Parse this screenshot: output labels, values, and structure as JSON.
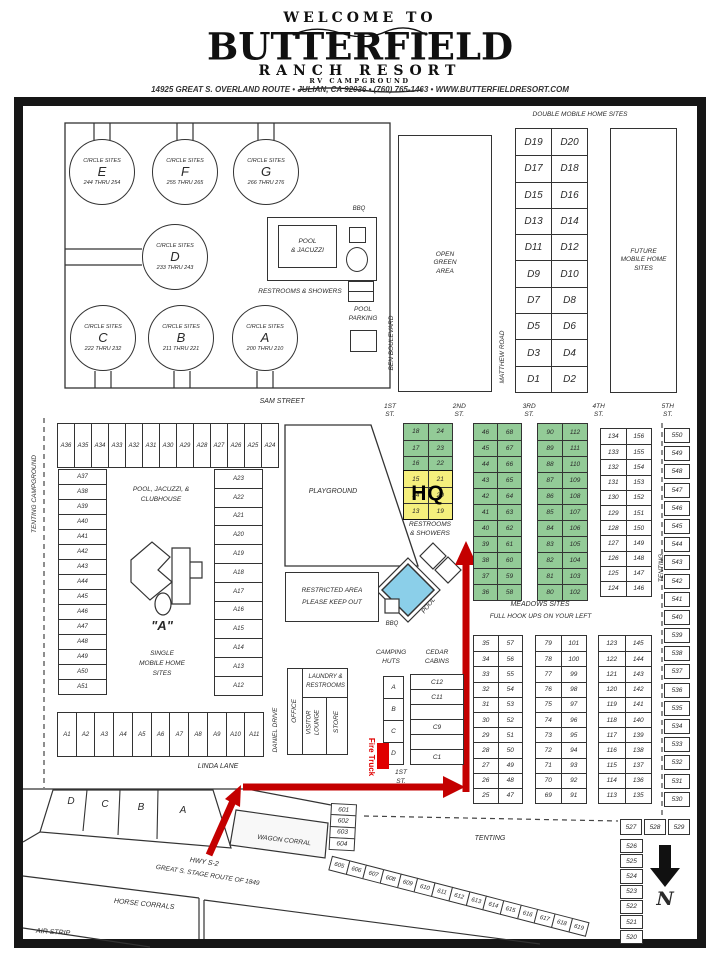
{
  "header": {
    "welcome": "WELCOME TO",
    "title": "BUTTERFIELD",
    "subtitle": "RANCH RESORT",
    "tagline": "RV CAMPGROUND",
    "address": "14925 GREAT S. OVERLAND ROUTE   •   JULIAN, CA 92036   •   (760) 765-1463   •   WWW.BUTTERFIELDRESORT.COM"
  },
  "colors": {
    "site_green": "#93cb97",
    "hq_yellow": "#f5ef7d",
    "pool_blue": "#8bcfe9",
    "route_red": "#c40000"
  },
  "top": {
    "double_mobile_header": "DOUBLE MOBILE HOME SITES",
    "circles": [
      {
        "label": "CIRCLE SITES",
        "name": "E",
        "range": "244 THRU 254"
      },
      {
        "label": "CIRCLE SITES",
        "name": "F",
        "range": "255 THRU 265"
      },
      {
        "label": "CIRCLE SITES",
        "name": "G",
        "range": "266 THRU 276"
      },
      {
        "label": "CIRCLE SITES",
        "name": "D",
        "range": "233 THRU 243"
      },
      {
        "label": "CIRCLE SITES",
        "name": "C",
        "range": "222 THRU 232"
      },
      {
        "label": "CIRCLE SITES",
        "name": "B",
        "range": "211 THRU 221"
      },
      {
        "label": "CIRCLE SITES",
        "name": "A",
        "range": "200 THRU 210"
      }
    ],
    "bbq": "BBQ",
    "pool_jacuzzi": [
      "POOL",
      "& JACUZZI"
    ],
    "restrooms_showers": "RESTROOMS & SHOWERS",
    "pool_parking": [
      "POOL",
      "PARKING"
    ],
    "open_green": [
      "OPEN",
      "GREEN",
      "AREA"
    ],
    "future": [
      "FUTURE",
      "MOBILE HOME",
      "SITES"
    ],
    "ben_blvd": "BEN BOULEVARD",
    "matthew_rd": "MATTHEW ROAD",
    "sam_st": "SAM STREET",
    "d_rows": [
      [
        "D19",
        "D20"
      ],
      [
        "D17",
        "D18"
      ],
      [
        "D15",
        "D16"
      ],
      [
        "D13",
        "D14"
      ],
      [
        "D11",
        "D12"
      ],
      [
        "D9",
        "D10"
      ],
      [
        "D7",
        "D8"
      ],
      [
        "D5",
        "D6"
      ],
      [
        "D3",
        "D4"
      ],
      [
        "D1",
        "D2"
      ]
    ]
  },
  "streets": [
    {
      "n": "1ST",
      "s": "ST."
    },
    {
      "n": "2ND",
      "s": "ST."
    },
    {
      "n": "3RD",
      "s": "ST."
    },
    {
      "n": "4TH",
      "s": "ST."
    },
    {
      "n": "5TH",
      "s": "ST."
    }
  ],
  "hq_area": {
    "green_rows": [
      [
        "18",
        "24"
      ],
      [
        "17",
        "23"
      ],
      [
        "16",
        "22"
      ]
    ],
    "yellow_rows": [
      [
        "15",
        "21"
      ],
      [
        "14",
        "20"
      ],
      [
        "13",
        "19"
      ]
    ],
    "hq": "HQ",
    "restrooms": [
      "RESTROOMS",
      "& SHOWERS"
    ]
  },
  "green2": [
    [
      "46",
      "68"
    ],
    [
      "45",
      "67"
    ],
    [
      "44",
      "66"
    ],
    [
      "43",
      "65"
    ],
    [
      "42",
      "64"
    ],
    [
      "41",
      "63"
    ],
    [
      "40",
      "62"
    ],
    [
      "39",
      "61"
    ],
    [
      "38",
      "60"
    ],
    [
      "37",
      "59"
    ],
    [
      "36",
      "58"
    ]
  ],
  "green3": [
    [
      "90",
      "112"
    ],
    [
      "89",
      "111"
    ],
    [
      "88",
      "110"
    ],
    [
      "87",
      "109"
    ],
    [
      "86",
      "108"
    ],
    [
      "85",
      "107"
    ],
    [
      "84",
      "106"
    ],
    [
      "83",
      "105"
    ],
    [
      "82",
      "104"
    ],
    [
      "81",
      "103"
    ],
    [
      "80",
      "102"
    ]
  ],
  "col4": [
    [
      "134",
      "156"
    ],
    [
      "133",
      "155"
    ],
    [
      "132",
      "154"
    ],
    [
      "131",
      "153"
    ],
    [
      "130",
      "152"
    ],
    [
      "129",
      "151"
    ],
    [
      "128",
      "150"
    ],
    [
      "127",
      "149"
    ],
    [
      "126",
      "148"
    ],
    [
      "125",
      "147"
    ],
    [
      "124",
      "146"
    ]
  ],
  "meadows": {
    "title": "MEADOWS SITES",
    "subtitle": "FULL HOOK UPS ON YOUR LEFT",
    "t1": [
      [
        "35",
        "57"
      ],
      [
        "34",
        "56"
      ],
      [
        "33",
        "55"
      ],
      [
        "32",
        "54"
      ],
      [
        "31",
        "53"
      ],
      [
        "30",
        "52"
      ],
      [
        "29",
        "51"
      ],
      [
        "28",
        "50"
      ],
      [
        "27",
        "49"
      ],
      [
        "26",
        "48"
      ],
      [
        "25",
        "47"
      ]
    ],
    "t2": [
      [
        "79",
        "101"
      ],
      [
        "78",
        "100"
      ],
      [
        "77",
        "99"
      ],
      [
        "76",
        "98"
      ],
      [
        "75",
        "97"
      ],
      [
        "74",
        "96"
      ],
      [
        "73",
        "95"
      ],
      [
        "72",
        "94"
      ],
      [
        "71",
        "93"
      ],
      [
        "70",
        "92"
      ],
      [
        "69",
        "91"
      ]
    ],
    "t3": [
      [
        "123",
        "145"
      ],
      [
        "122",
        "144"
      ],
      [
        "121",
        "143"
      ],
      [
        "120",
        "142"
      ],
      [
        "119",
        "141"
      ],
      [
        "118",
        "140"
      ],
      [
        "117",
        "139"
      ],
      [
        "116",
        "138"
      ],
      [
        "115",
        "137"
      ],
      [
        "114",
        "136"
      ],
      [
        "113",
        "135"
      ]
    ]
  },
  "a_block": {
    "top_row": [
      "A36",
      "A35",
      "A34",
      "A33",
      "A32",
      "A31",
      "A30",
      "A29",
      "A28",
      "A27",
      "A26",
      "A25",
      "A24"
    ],
    "left_col": [
      "A37",
      "A38",
      "A39",
      "A40",
      "A41",
      "A42",
      "A43",
      "A44",
      "A45",
      "A46",
      "A47",
      "A48",
      "A49",
      "A50",
      "A51"
    ],
    "right_col": [
      "A23",
      "A22",
      "A21",
      "A20",
      "A19",
      "A18",
      "A17",
      "A16",
      "A15",
      "A14",
      "A13",
      "A12"
    ],
    "bottom_row": [
      "A1",
      "A2",
      "A3",
      "A4",
      "A5",
      "A6",
      "A7",
      "A8",
      "A9",
      "A10",
      "A11"
    ],
    "pool_club": [
      "POOL, JACUZZI, &",
      "CLUBHOUSE"
    ],
    "center": [
      "\"A\"",
      "SINGLE",
      "MOBILE HOME",
      "SITES"
    ]
  },
  "west": {
    "tenting_campground": "TENTING CAMPGROUND"
  },
  "mid": {
    "playground": "PLAYGROUND",
    "restricted": [
      "RESTRICTED AREA",
      "PLEASE KEEP OUT"
    ],
    "pool": "POOL",
    "bbq": "BBQ"
  },
  "south": {
    "office": "OFFICE",
    "laundry": [
      "LAUNDRY &",
      "RESTROOMS"
    ],
    "visitor": [
      "VISITOR",
      "LOUNGE"
    ],
    "store": "STORE",
    "daniel": "DANIEL DRIVE",
    "linda": "LINDA LANE",
    "camping": [
      "CAMPING",
      "HUTS"
    ],
    "huts": [
      "A",
      "B",
      "C",
      "D"
    ],
    "cedar": [
      "CEDAR",
      "CABINS"
    ],
    "cabins": [
      "C12",
      "C11",
      "",
      "C9",
      "",
      "C1"
    ],
    "first_st": [
      "1ST",
      "ST."
    ],
    "fire_truck": "Fire Truck",
    "entry": [
      "D",
      "C",
      "B",
      "A"
    ],
    "hwy": "HWY S-2",
    "stage": "GREAT S. STAGE ROUTE OF 1849",
    "wagon": "WAGON CORRAL",
    "horse": "HORSE CORRALS",
    "air": "AIR STRIP",
    "tenting": "TENTING",
    "wagon_col": [
      "601",
      "602",
      "603",
      "604"
    ],
    "diag": [
      "605",
      "606",
      "607",
      "608",
      "609",
      "610",
      "611",
      "612",
      "613",
      "614",
      "615",
      "616",
      "617",
      "618",
      "619"
    ]
  },
  "east": {
    "tenting": "TENTING",
    "col5": [
      "550",
      "549",
      "548",
      "547",
      "546",
      "545",
      "544",
      "543",
      "542",
      "541",
      "540",
      "539",
      "538",
      "537",
      "536",
      "535",
      "534",
      "533",
      "532",
      "531",
      "530"
    ],
    "corner_row": [
      "527",
      "528",
      "529"
    ],
    "corner_col": [
      "526",
      "525",
      "524",
      "523",
      "522",
      "521",
      "520"
    ],
    "north": "N"
  }
}
